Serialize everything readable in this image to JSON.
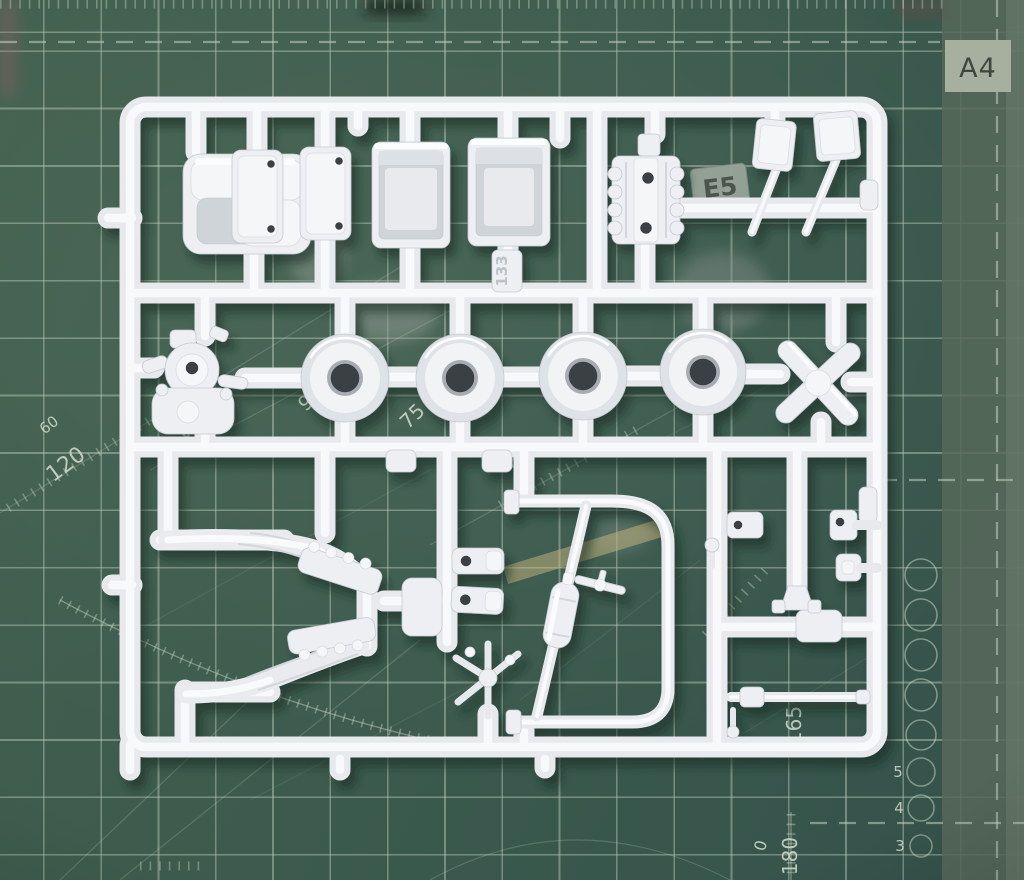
{
  "scene": {
    "title": "White model kit sprue (injection-moulded parts tree) lying on a green cutting mat",
    "type": "photograph"
  },
  "mat": {
    "base_color": "#3c5b4e",
    "grid_color": "#bac7b6",
    "labels": [
      {
        "text": "A4"
      },
      {
        "text": "60"
      },
      {
        "text": "120"
      },
      {
        "text": "105"
      },
      {
        "text": "90"
      },
      {
        "text": "75"
      },
      {
        "text": "60"
      },
      {
        "text": "165"
      },
      {
        "text": "180"
      },
      {
        "text": "0"
      },
      {
        "text": "5"
      },
      {
        "text": "4"
      },
      {
        "text": "3"
      }
    ]
  },
  "sprue": {
    "plastic_color": "#edeff2",
    "tags": [
      {
        "text": "E5"
      },
      {
        "text": "133"
      }
    ]
  }
}
